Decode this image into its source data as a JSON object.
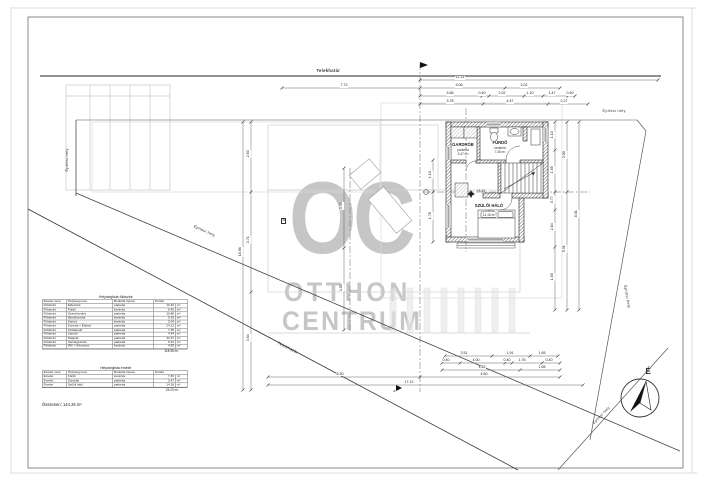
{
  "watermark": {
    "big": "OC",
    "line1": "OTTHON",
    "line2": "CENTRUM",
    "color": "#c6c6c6"
  },
  "boundaries": {
    "telekhatar_top": "Telekhatár",
    "telekhatar_diag": "Telekhatár",
    "epitesi_hely_left": "Építési hely",
    "epitesi_hely_diag_left": "Építési hely",
    "epitesi_hely_top_right": "Építési hely",
    "epitesi_hely_diag_right": "Építési hely",
    "epitesi_hely_north": "Építési hely",
    "north_letter": "É"
  },
  "plan": {
    "rooms": [
      {
        "name": "GARDRÓB",
        "floor": "parketta",
        "area": "3.47 m²"
      },
      {
        "name": "FÜRDŐ",
        "floor": "kerámia",
        "area": "7.45 m²"
      },
      {
        "name": "SZÜLŐI HÁLÓ",
        "floor": "parketta",
        "area": "14.18 m²"
      }
    ],
    "level_mark": "+3.10",
    "section_mark": "B",
    "axis_mark": "a"
  },
  "dims": {
    "top": [
      "11.13",
      "7.72",
      "3.06",
      "2.02",
      "3.56",
      "0.40",
      "2.02",
      "1.10",
      "1.47",
      "0.40",
      "3.78",
      "4.47",
      "2.27"
    ],
    "bottom": [
      "6.30",
      "4.50",
      "17.12",
      "3.51",
      "1.91",
      "1.65",
      "0.40",
      "4.00",
      "0.40",
      "1.76",
      "0.40",
      "4.62",
      "1.65"
    ],
    "left": [
      "2.63",
      "3.71",
      "3.64",
      "16.96"
    ],
    "right": [
      "1.10",
      "1.65",
      "0.77",
      "2.84",
      "1.65",
      "3.00",
      "5.01",
      "8.01"
    ],
    "plan": [
      "1.10",
      "1.78",
      "3.49",
      "3.50"
    ]
  },
  "room_tables": [
    {
      "title": "Helyiséglista földszint",
      "columns": [
        "Emelet neve",
        "Helyiség neve",
        "Burkolat típusa",
        "Terület"
      ],
      "rows": [
        [
          "Földszint",
          "Előszoba",
          "parketta",
          "10.46",
          "m²"
        ],
        [
          "Földszint",
          "Fürdő",
          "kerámia",
          "6.40",
          "m²"
        ],
        [
          "Földszint",
          "Gyerekszoba",
          "parketta",
          "10.88",
          "m²"
        ],
        [
          "Földszint",
          "Mosókonyha",
          "kerámia",
          "5.10",
          "m²"
        ],
        [
          "Földszint",
          "Kamra",
          "kerámia",
          "2.04",
          "m²"
        ],
        [
          "Földszint",
          "Konyha + Étkező",
          "parketta",
          "24.13",
          "m²"
        ],
        [
          "Földszint",
          "Közlekedő",
          "parketta",
          "7.35",
          "m²"
        ],
        [
          "Földszint",
          "Lépcső",
          "parketta",
          "4.44",
          "m²"
        ],
        [
          "Földszint",
          "Nappali",
          "parketta",
          "32.37",
          "m²"
        ],
        [
          "Földszint",
          "Vendégszoba",
          "parketta",
          "9.44",
          "m²"
        ],
        [
          "Földszint",
          "WC + Kézmosó",
          "kerámia",
          "4.92",
          "m²"
        ]
      ],
      "subtotal": "118.96 m²"
    },
    {
      "title": "Helyiséglista emelet",
      "columns": [
        "Emelet neve",
        "Helyiség neve",
        "Burkolat típusa",
        "Terület"
      ],
      "rows": [
        [
          "Emelet",
          "Fürdő",
          "kerámia",
          "7.45",
          "m²"
        ],
        [
          "Emelet",
          "Gardrób",
          "parketta",
          "3.47",
          "m²"
        ],
        [
          "Emelet",
          "Szülői háló",
          "parketta",
          "14.18",
          "m²"
        ]
      ],
      "subtotal": "25.29 m²"
    }
  ],
  "grand_total": "Összesen: 144.25 m²"
}
